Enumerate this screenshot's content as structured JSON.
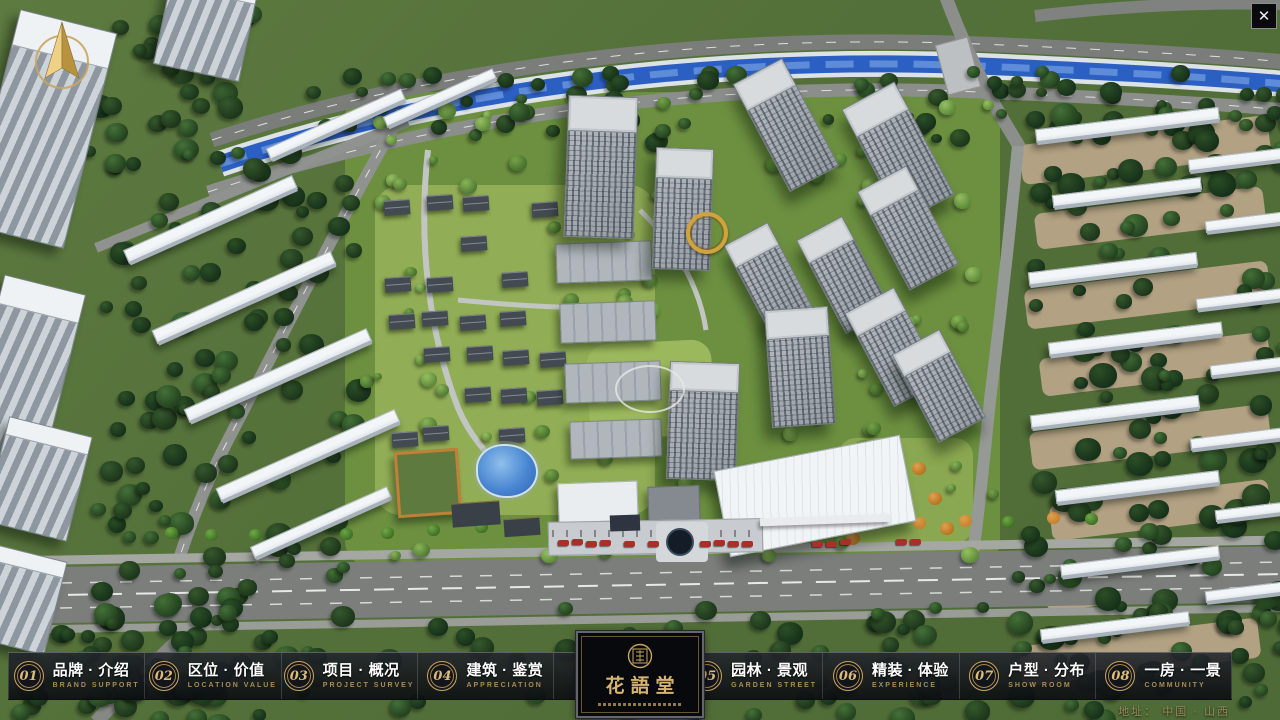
{
  "window": {
    "close_glyph": "✕"
  },
  "logo": {
    "title": "花語堂"
  },
  "menu": {
    "items": [
      {
        "num": "01",
        "label": "品牌 · 介绍",
        "sublabel": "BRAND SUPPORT"
      },
      {
        "num": "02",
        "label": "区位 · 价值",
        "sublabel": "LOCATION VALUE"
      },
      {
        "num": "03",
        "label": "项目 · 概况",
        "sublabel": "PROJECT SURVEY"
      },
      {
        "num": "04",
        "label": "建筑 · 鉴赏",
        "sublabel": "APPRECIATION"
      },
      {
        "num": "05",
        "label": "园林 · 景观",
        "sublabel": "GARDEN STREET"
      },
      {
        "num": "06",
        "label": "精装 · 体验",
        "sublabel": "EXPERIENCE"
      },
      {
        "num": "07",
        "label": "户型 · 分布",
        "sublabel": "SHOW ROOM"
      },
      {
        "num": "08",
        "label": "一房 · 一景",
        "sublabel": "COMMUNITY"
      }
    ]
  },
  "footer": {
    "address": "地址：  中国 · 山西"
  },
  "colors": {
    "gold": "#c9a55e",
    "bar_background": "rgba(13,16,22,0.88)",
    "river_blue": "#2c5fc2",
    "tree_dark": "#2a4a24",
    "tree_light": "#6f9c44"
  }
}
